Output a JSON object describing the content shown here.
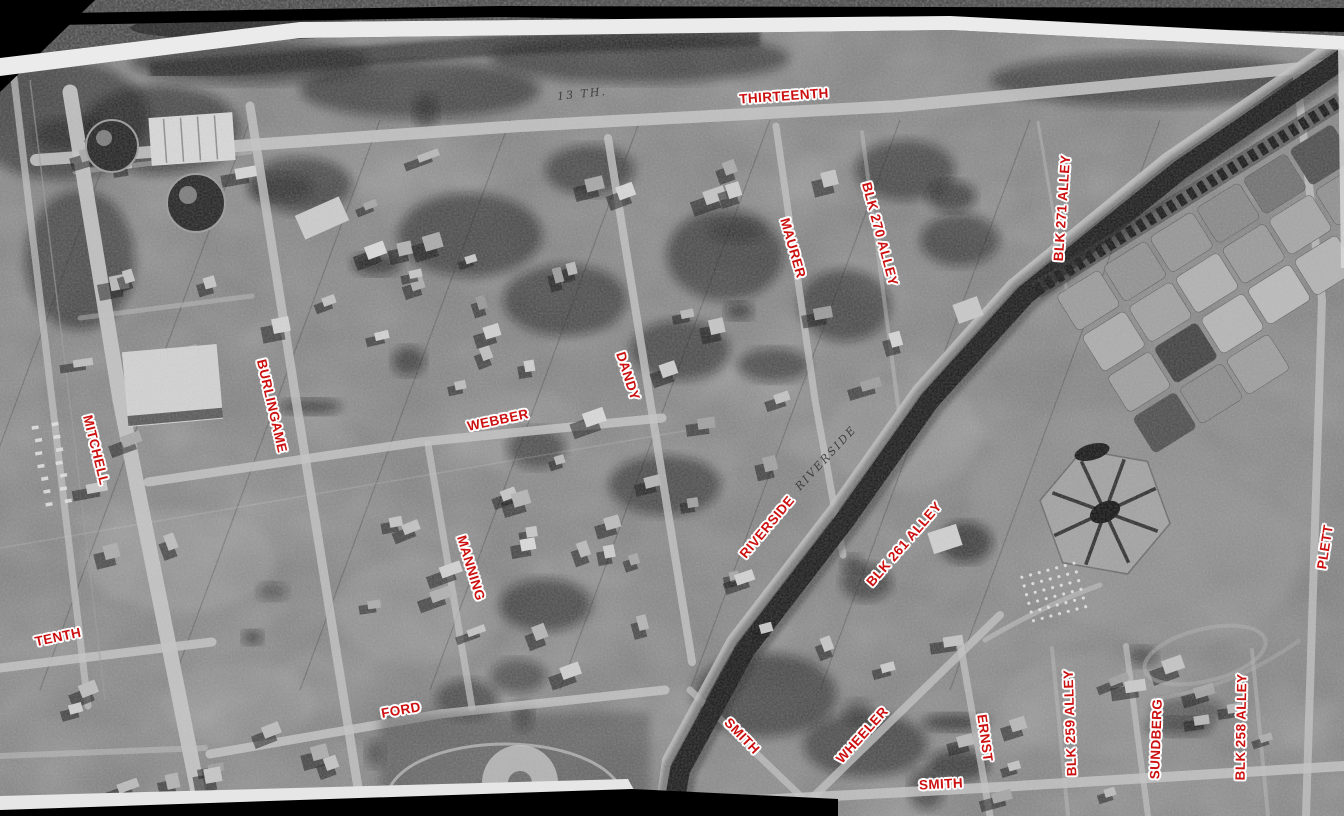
{
  "view": {
    "width": 1344,
    "height": 816
  },
  "style": {
    "label_color": "#cc1010",
    "label_halo": "#ffffff",
    "annotation_color": "#2a2a2a",
    "background": "#000000"
  },
  "street_labels": [
    {
      "id": "thirteenth",
      "text": "THIRTEENTH",
      "x": 784,
      "y": 96,
      "rot": -4
    },
    {
      "id": "mitchell",
      "text": "MITCHELL",
      "x": 96,
      "y": 450,
      "rot": 76
    },
    {
      "id": "tenth",
      "text": "TENTH",
      "x": 58,
      "y": 637,
      "rot": -12
    },
    {
      "id": "burlingame",
      "text": "BURLINGAME",
      "x": 272,
      "y": 406,
      "rot": 77
    },
    {
      "id": "webber",
      "text": "WEBBER",
      "x": 498,
      "y": 420,
      "rot": -12
    },
    {
      "id": "manning",
      "text": "MANNING",
      "x": 471,
      "y": 568,
      "rot": 73
    },
    {
      "id": "dandy",
      "text": "DANDY",
      "x": 628,
      "y": 376,
      "rot": 72
    },
    {
      "id": "maurer",
      "text": "MAURER",
      "x": 793,
      "y": 248,
      "rot": 74
    },
    {
      "id": "blk-270-alley",
      "text": "BLK 270 ALLEY",
      "x": 880,
      "y": 234,
      "rot": 75
    },
    {
      "id": "blk-271-alley",
      "text": "BLK 271 ALLEY",
      "x": 1062,
      "y": 208,
      "rot": -86
    },
    {
      "id": "riverside",
      "text": "RIVERSIDE",
      "x": 767,
      "y": 527,
      "rot": -50
    },
    {
      "id": "blk-261-alley",
      "text": "BLK 261 ALLEY",
      "x": 904,
      "y": 544,
      "rot": -49
    },
    {
      "id": "ford",
      "text": "FORD",
      "x": 401,
      "y": 710,
      "rot": -10
    },
    {
      "id": "smith-upper",
      "text": "SMITH",
      "x": 742,
      "y": 736,
      "rot": 46
    },
    {
      "id": "wheeler",
      "text": "WHEELER",
      "x": 862,
      "y": 735,
      "rot": -48
    },
    {
      "id": "ernst",
      "text": "ERNST",
      "x": 985,
      "y": 738,
      "rot": 82
    },
    {
      "id": "smith-lower",
      "text": "SMITH",
      "x": 941,
      "y": 784,
      "rot": -3
    },
    {
      "id": "blk-259-alley",
      "text": "BLK 259 ALLEY",
      "x": 1070,
      "y": 723,
      "rot": -92
    },
    {
      "id": "sundberg",
      "text": "SUNDBERG",
      "x": 1156,
      "y": 739,
      "rot": -88
    },
    {
      "id": "blk-258-alley",
      "text": "BLK 258 ALLEY",
      "x": 1241,
      "y": 727,
      "rot": -89
    },
    {
      "id": "plett",
      "text": "PLETT",
      "x": 1325,
      "y": 547,
      "rot": -81
    }
  ],
  "photo_annotations": [
    {
      "id": "thirteenth-handwritten",
      "text": "13 TH.",
      "x": 582,
      "y": 94,
      "rot": -6
    },
    {
      "id": "riverside-handwritten",
      "text": "RIVERSIDE",
      "x": 826,
      "y": 458,
      "rot": -47
    }
  ]
}
